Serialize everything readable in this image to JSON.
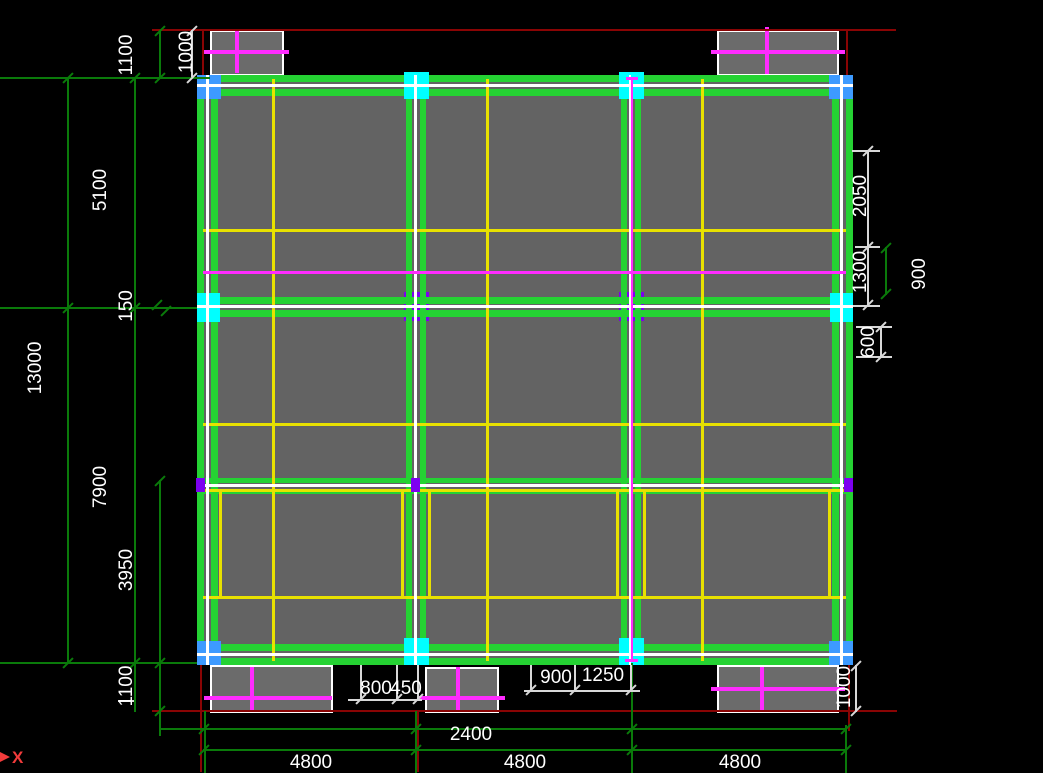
{
  "drawing": {
    "type": "cad-structural-floor-plan",
    "axis": {
      "x_label": "X"
    },
    "dims": {
      "top_left": {
        "d1100": "1100",
        "d1000": "1000"
      },
      "left": {
        "d5100": "5100",
        "d150": "150",
        "d13000": "13000",
        "d7900": "7900",
        "d3950": "3950",
        "d1100": "1100"
      },
      "right": {
        "d2050": "2050",
        "d1300": "1300",
        "d900": "900",
        "d600": "600",
        "d1000": "1000"
      },
      "bottom": {
        "d800": "800",
        "d450": "450",
        "d900": "900",
        "d1250": "1250",
        "d2400": "2400",
        "d4800a": "4800",
        "d4800b": "4800",
        "d4800c": "4800"
      }
    },
    "colors": {
      "beam_green": "#25d233",
      "secondary_beam_yellow": "#e8e100",
      "centerline_white": "#ffffff",
      "canopy_cross_magenta": "#ff2bff",
      "edge_column_cyan": "#00ffff",
      "corner_column_blue": "#3d9aff",
      "interior_column_purple": "#7d00f0",
      "slab_gray": "#636363",
      "dimension_green": "#0a7a0a",
      "reference_red": "#8a0404",
      "text_white": "#ffffff"
    }
  }
}
